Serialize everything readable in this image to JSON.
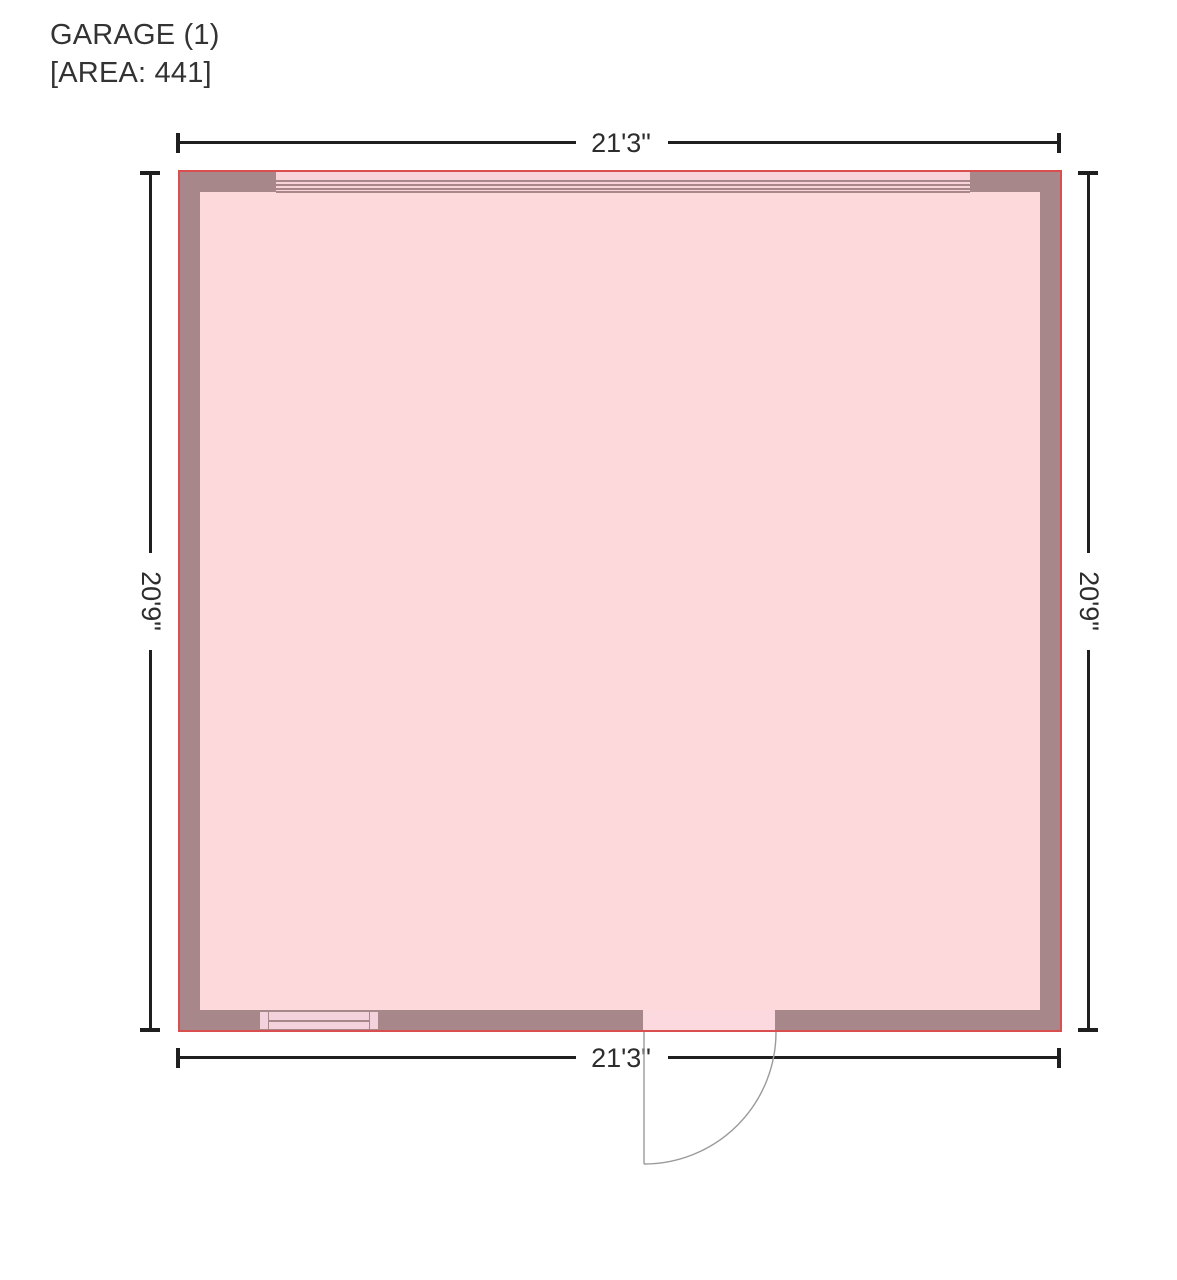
{
  "title": {
    "room_name": "GARAGE (1)",
    "area_label": "[AREA: 441]"
  },
  "room": {
    "name": "GARAGE (1)",
    "area_value": "441",
    "width_label": "21'3\"",
    "height_label": "20'9\""
  },
  "dimensions": {
    "top": "21'3\"",
    "bottom": "21'3\"",
    "left": "20'9\"",
    "right": "20'9\""
  },
  "colors": {
    "wall": "#a8878b",
    "floor": "#fed9db",
    "outline": "#d94f4f",
    "opening_fill": "#f8d4da",
    "window_fill": "#f3d2de",
    "dimension_line": "#1f1f1f",
    "door_swing": "#9a9a9a",
    "text": "#333333"
  }
}
